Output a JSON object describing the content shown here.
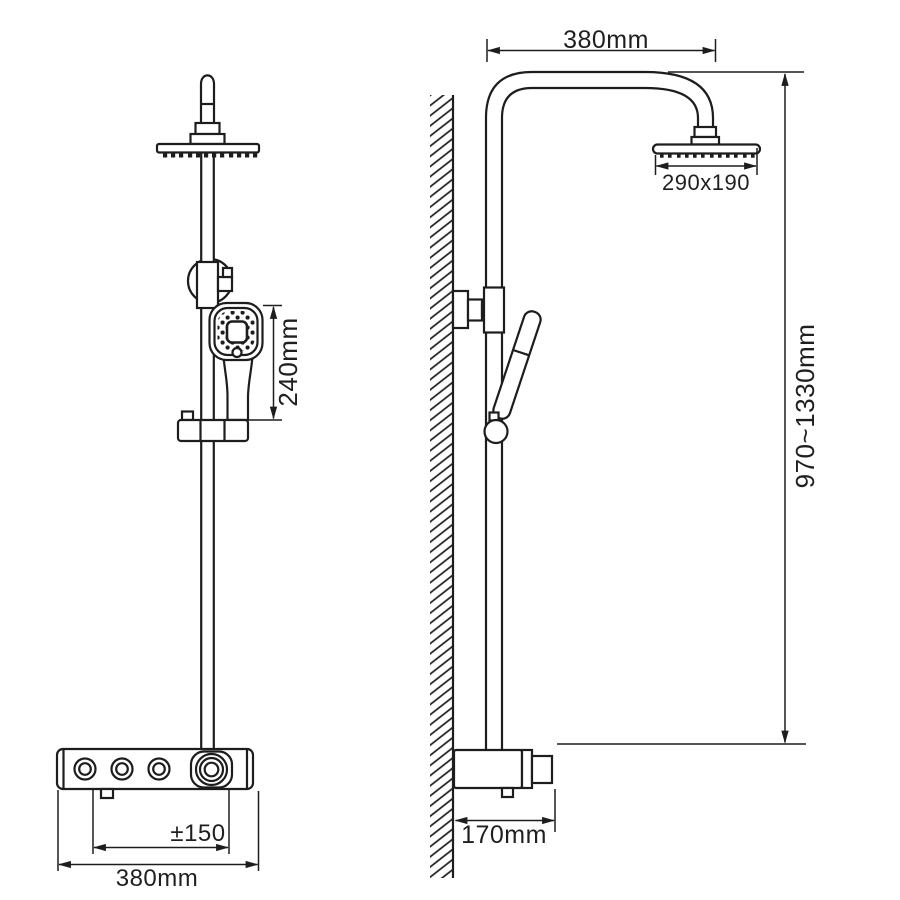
{
  "drawing": {
    "line_color": "#1d1d1d",
    "background": "#ffffff"
  },
  "dimensions": {
    "top_width": "380mm",
    "head_size": "290x190",
    "hand_shower_span": "240mm",
    "overall_height": "970~1330mm",
    "valve_adjust": "±150",
    "bottom_width": "380mm",
    "depth": "170mm"
  }
}
